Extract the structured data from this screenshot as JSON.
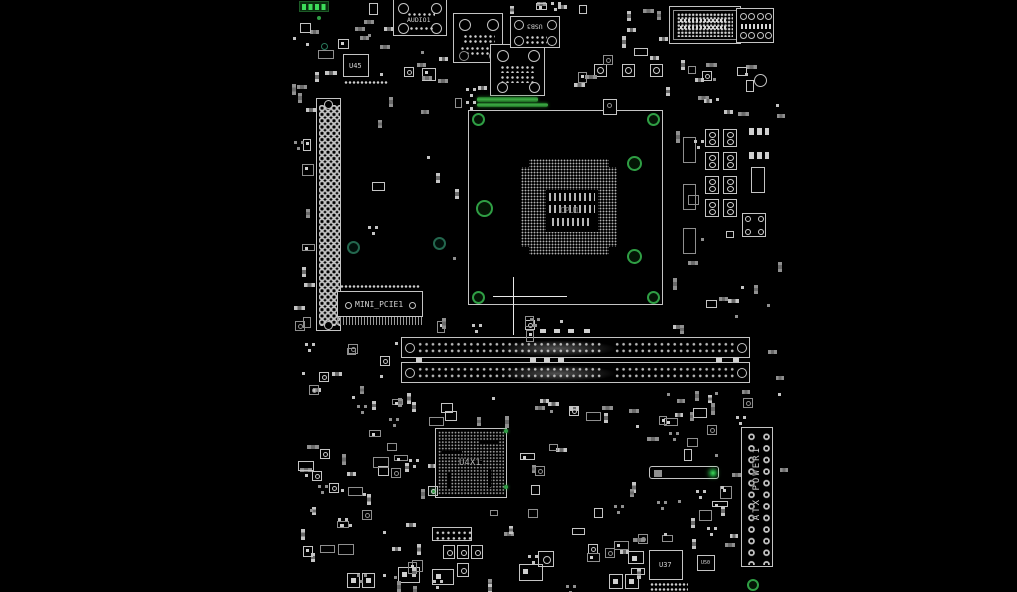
{
  "view": {
    "background": "#000000",
    "width": 1017,
    "height": 592
  },
  "labels": {
    "audio_connector": "AUDIO1",
    "usb_connector": "USB3",
    "u45": "U45",
    "mini_pcie": "MINI_PCIE1",
    "atx_power": "ATX POWER1",
    "chipset": "U4X1",
    "u37": "U37",
    "u50": "U50",
    "cpu_socket": "CPU1"
  },
  "colors": {
    "background": "#000000",
    "silkscreen": "#c4c4c4",
    "silkscreen_dim": "#8f8f8f",
    "pad": "#cfcfcf",
    "label_text": "#d2d2d2",
    "green": "#2f9e44",
    "green_bright": "#3ddc5a",
    "green_dark": "#123f1e",
    "teal": "#2a7a5c"
  }
}
